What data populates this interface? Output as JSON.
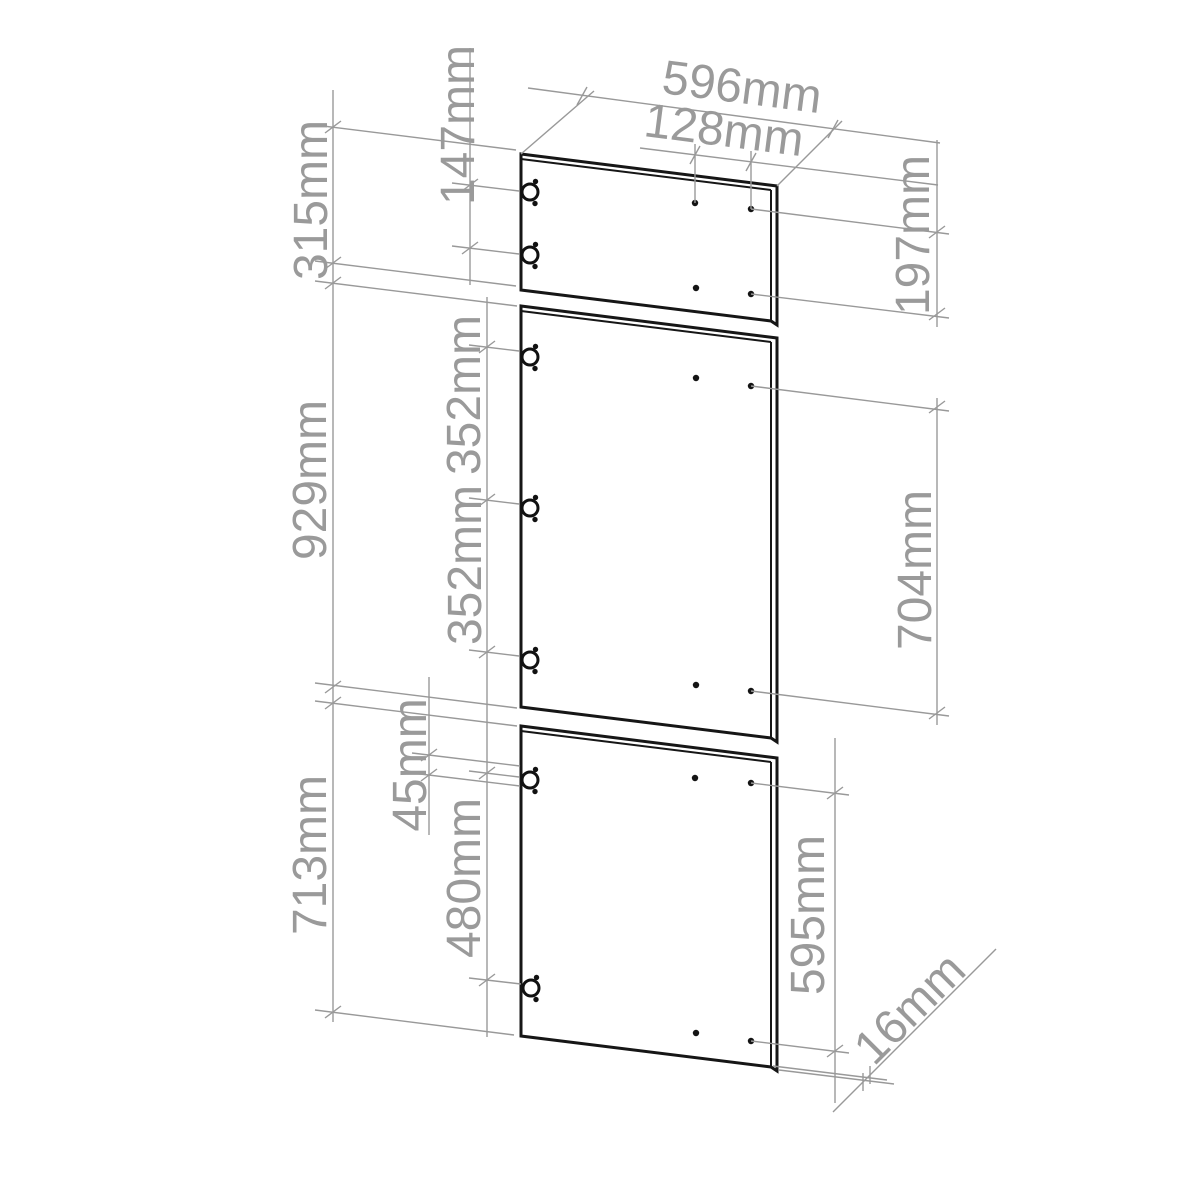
{
  "drawing": {
    "title": "cabinet-door-dimension-drawing",
    "units": "mm",
    "dimensions": {
      "door_width": "596mm",
      "hole_spacing_horizontal": "128mm",
      "top_hinge_spacing": "147mm",
      "top_door_height": "315mm",
      "top_right_hole_spacing": "197mm",
      "middle_door_height": "929mm",
      "middle_hinge_spacing_upper": "352mm",
      "middle_hinge_spacing_lower": "352mm",
      "middle_right_hole_spacing": "704mm",
      "bottom_hinge_top_offset": "45mm",
      "bottom_door_height": "713mm",
      "bottom_hinge_spacing": "480mm",
      "bottom_right_hole_spacing": "595mm",
      "door_thickness": "16mm"
    },
    "panels": [
      {
        "name": "top-door"
      },
      {
        "name": "middle-door"
      },
      {
        "name": "bottom-door"
      }
    ]
  }
}
